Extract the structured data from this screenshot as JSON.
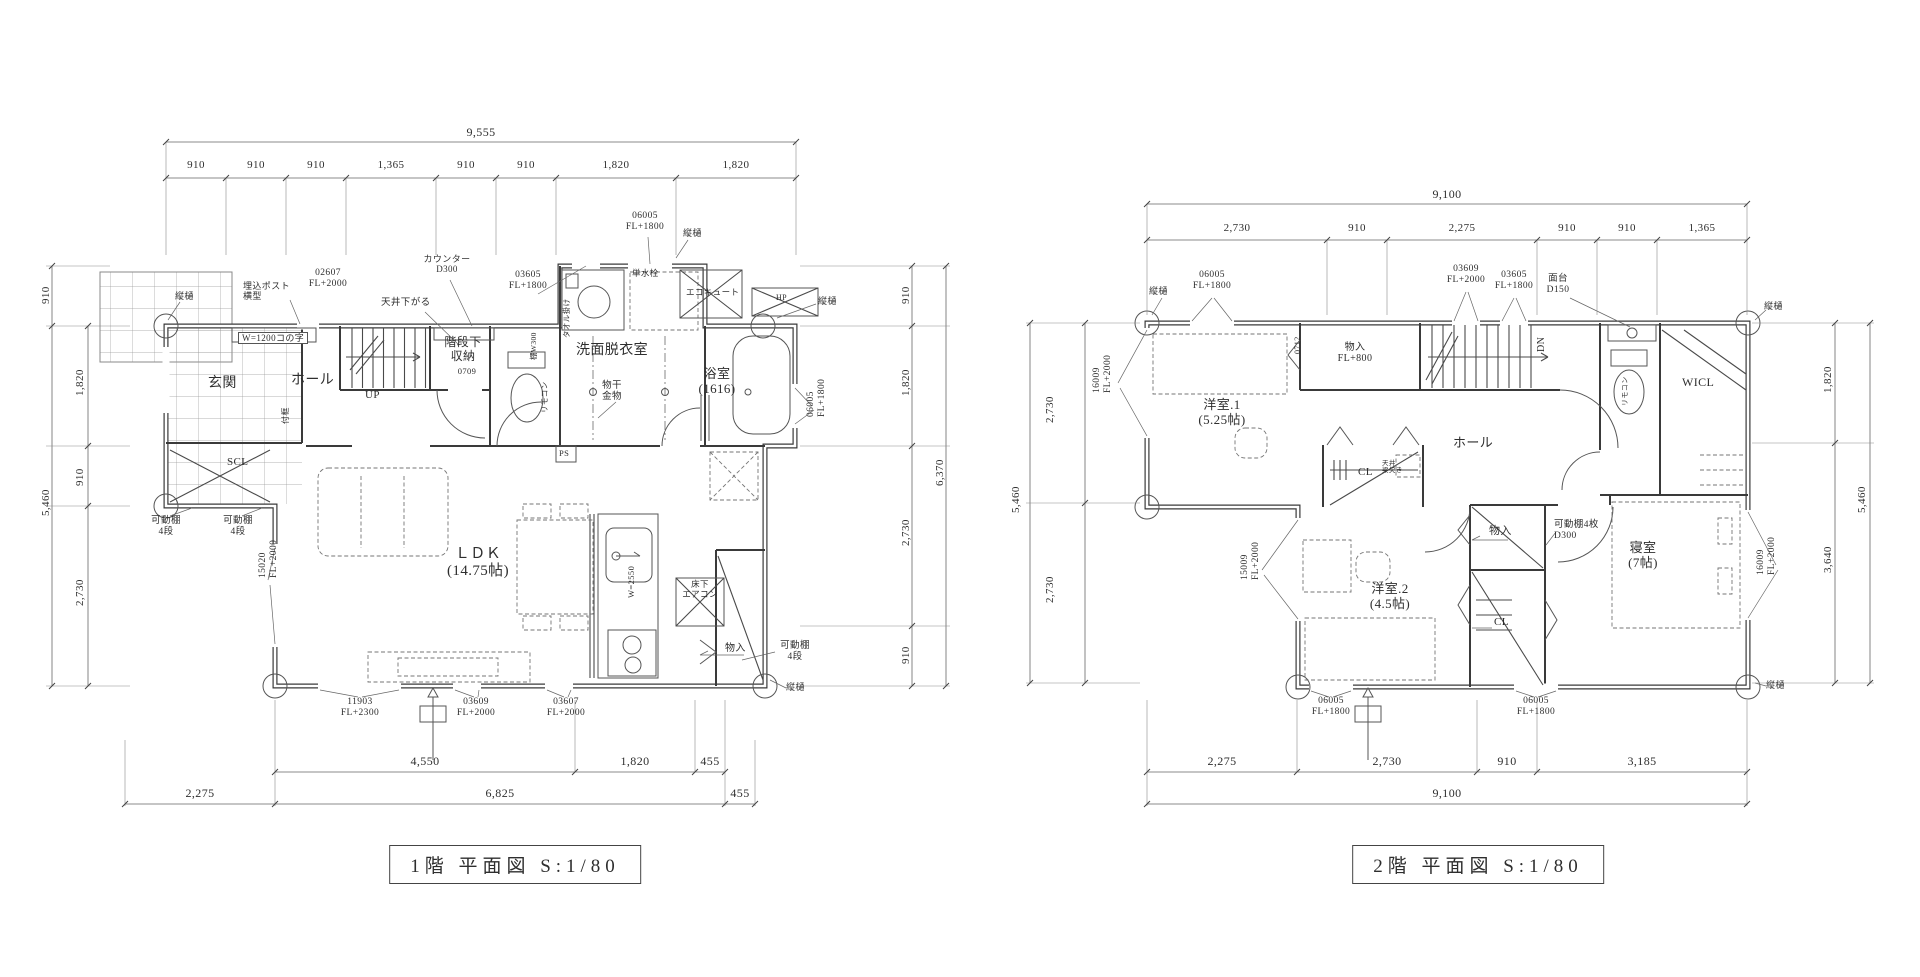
{
  "sheet": {
    "background": "#ffffff",
    "line_color": "#3a3a3a"
  },
  "floor1": {
    "title": "1階  平面図 S:1/80",
    "labels": [
      {
        "n": "dim-overall-width",
        "t": "9,555",
        "x": 481,
        "y": 126,
        "fs": 12,
        "c": 1
      },
      {
        "n": "dim-seg",
        "t": "910",
        "x": 196,
        "y": 159,
        "fs": 11,
        "c": 1
      },
      {
        "n": "dim-seg",
        "t": "910",
        "x": 256,
        "y": 159,
        "fs": 11,
        "c": 1
      },
      {
        "n": "dim-seg",
        "t": "910",
        "x": 316,
        "y": 159,
        "fs": 11,
        "c": 1
      },
      {
        "n": "dim-seg",
        "t": "1,365",
        "x": 391,
        "y": 159,
        "fs": 11,
        "c": 1
      },
      {
        "n": "dim-seg",
        "t": "910",
        "x": 466,
        "y": 159,
        "fs": 11,
        "c": 1
      },
      {
        "n": "dim-seg",
        "t": "910",
        "x": 526,
        "y": 159,
        "fs": 11,
        "c": 1
      },
      {
        "n": "dim-seg",
        "t": "1,820",
        "x": 616,
        "y": 159,
        "fs": 11,
        "c": 1
      },
      {
        "n": "dim-seg",
        "t": "1,820",
        "x": 736,
        "y": 159,
        "fs": 11,
        "c": 1
      },
      {
        "n": "downspout-label",
        "t": "縦樋",
        "x": 175,
        "y": 291,
        "fs": 9
      },
      {
        "n": "post-label",
        "t": "埋込ポスト\n横型",
        "x": 243,
        "y": 281,
        "fs": 9
      },
      {
        "n": "window-code",
        "t": "02607\nFL+2000",
        "x": 328,
        "y": 268,
        "fs": 9.5,
        "c": 1
      },
      {
        "n": "shelf-label",
        "t": "W=1200コの字",
        "x": 238,
        "y": 332,
        "fs": 9,
        "b": 1
      },
      {
        "n": "ceiling-label",
        "t": "天井下がる",
        "x": 381,
        "y": 298,
        "fs": 9.5
      },
      {
        "n": "counter-label",
        "t": "カウンター\nD300",
        "x": 447,
        "y": 254,
        "fs": 9,
        "c": 1
      },
      {
        "n": "room-label",
        "t": "階段下\n収納",
        "x": 463,
        "y": 336,
        "fs": 12,
        "c": 1
      },
      {
        "n": "door-code",
        "t": "0709",
        "x": 467,
        "y": 367,
        "fs": 8.5,
        "c": 1
      },
      {
        "n": "window-code",
        "t": "03605\nFL+1800",
        "x": 528,
        "y": 270,
        "fs": 9.5,
        "c": 1
      },
      {
        "n": "window-code",
        "t": "06005\nFL+1800",
        "x": 645,
        "y": 211,
        "fs": 9.5,
        "c": 1
      },
      {
        "n": "downspout-label",
        "t": "縦樋",
        "x": 683,
        "y": 228,
        "fs": 9
      },
      {
        "n": "fixture-label",
        "t": "単水栓",
        "x": 632,
        "y": 269,
        "fs": 8.5
      },
      {
        "n": "equipment-label",
        "t": "エコキュート",
        "x": 686,
        "y": 288,
        "fs": 8.5
      },
      {
        "n": "equipment-label",
        "t": "HP",
        "x": 776,
        "y": 293,
        "fs": 8
      },
      {
        "n": "downspout-label",
        "t": "縦樋",
        "x": 818,
        "y": 296,
        "fs": 9
      },
      {
        "n": "room-label",
        "t": "玄関",
        "x": 208,
        "y": 376,
        "fs": 14
      },
      {
        "n": "room-label",
        "t": "ホール",
        "x": 291,
        "y": 373,
        "fs": 14
      },
      {
        "n": "stair-label",
        "t": "UP",
        "x": 365,
        "y": 389,
        "fs": 11
      },
      {
        "n": "room-label",
        "t": "洗面脱衣室",
        "x": 576,
        "y": 343,
        "fs": 14
      },
      {
        "n": "fixture-label",
        "t": "物干\n金物",
        "x": 612,
        "y": 381,
        "fs": 9.5,
        "c": 1
      },
      {
        "n": "room-label",
        "t": "浴室\n(1616)",
        "x": 717,
        "y": 367,
        "fs": 13,
        "c": 1
      },
      {
        "n": "window-code",
        "t": "06005\nFL+1800",
        "x": 806,
        "y": 431,
        "fs": 9.5,
        "r": 1
      },
      {
        "n": "room-label",
        "t": "SCL",
        "x": 227,
        "y": 456,
        "fs": 11
      },
      {
        "n": "label",
        "t": "付框",
        "x": 281,
        "y": 438,
        "fs": 8,
        "r": 1
      },
      {
        "n": "label",
        "t": "棚W300",
        "x": 530,
        "y": 374,
        "fs": 7.5,
        "r": 1
      },
      {
        "n": "label",
        "t": "タオル掛け",
        "x": 563,
        "y": 352,
        "fs": 7.5,
        "r": 1
      },
      {
        "n": "label",
        "t": "リモコン",
        "x": 541,
        "y": 427,
        "fs": 7.5,
        "r": 1
      },
      {
        "n": "label",
        "t": "PS",
        "x": 559,
        "y": 449,
        "fs": 8.5
      },
      {
        "n": "shelf-label",
        "t": "可動棚\n4段",
        "x": 166,
        "y": 516,
        "fs": 9.5,
        "c": 1
      },
      {
        "n": "shelf-label",
        "t": "可動棚\n4段",
        "x": 238,
        "y": 516,
        "fs": 9.5,
        "c": 1
      },
      {
        "n": "window-code",
        "t": "15020\nFL+2000",
        "x": 258,
        "y": 592,
        "fs": 9.5,
        "r": 1
      },
      {
        "n": "room-label",
        "t": "ＬＤＫ\n(14.75帖)",
        "x": 478,
        "y": 546,
        "fs": 15,
        "c": 1
      },
      {
        "n": "label",
        "t": "W=2550",
        "x": 627,
        "y": 612,
        "fs": 8.5,
        "r": 1
      },
      {
        "n": "equipment-label",
        "t": "床下\nエアコン",
        "x": 700,
        "y": 580,
        "fs": 8.5,
        "c": 1
      },
      {
        "n": "room-label",
        "t": "物入",
        "x": 725,
        "y": 643,
        "fs": 10
      },
      {
        "n": "shelf-label",
        "t": "可動棚\n4段",
        "x": 795,
        "y": 641,
        "fs": 9.5,
        "c": 1
      },
      {
        "n": "downspout-label",
        "t": "縦樋",
        "x": 786,
        "y": 682,
        "fs": 9
      },
      {
        "n": "window-code",
        "t": "11903\nFL+2300",
        "x": 360,
        "y": 697,
        "fs": 9.5,
        "c": 1
      },
      {
        "n": "window-code",
        "t": "03609\nFL+2000",
        "x": 476,
        "y": 697,
        "fs": 9.5,
        "c": 1
      },
      {
        "n": "window-code",
        "t": "03607\nFL+2000",
        "x": 566,
        "y": 697,
        "fs": 9.5,
        "c": 1
      },
      {
        "n": "dim-seg",
        "t": "4,550",
        "x": 425,
        "y": 755,
        "fs": 12,
        "c": 1
      },
      {
        "n": "dim-seg",
        "t": "1,820",
        "x": 635,
        "y": 755,
        "fs": 12,
        "c": 1
      },
      {
        "n": "dim-seg",
        "t": "455",
        "x": 710,
        "y": 755,
        "fs": 12,
        "c": 1
      },
      {
        "n": "dim-seg",
        "t": "2,275",
        "x": 200,
        "y": 787,
        "fs": 12,
        "c": 1
      },
      {
        "n": "dim-seg",
        "t": "6,825",
        "x": 500,
        "y": 787,
        "fs": 12,
        "c": 1
      },
      {
        "n": "dim-seg",
        "t": "455",
        "x": 740,
        "y": 787,
        "fs": 12,
        "c": 1
      },
      {
        "n": "dim-seg",
        "t": "910",
        "x": 40,
        "y": 318,
        "fs": 11,
        "r": 1
      },
      {
        "n": "dim-overall-height",
        "t": "5,460",
        "x": 40,
        "y": 530,
        "fs": 11,
        "r": 1
      },
      {
        "n": "dim-seg",
        "t": "1,820",
        "x": 74,
        "y": 410,
        "fs": 11,
        "r": 1
      },
      {
        "n": "dim-seg",
        "t": "910",
        "x": 74,
        "y": 500,
        "fs": 11,
        "r": 1
      },
      {
        "n": "dim-seg",
        "t": "2,730",
        "x": 74,
        "y": 620,
        "fs": 11,
        "r": 1
      },
      {
        "n": "dim-seg",
        "t": "910",
        "x": 900,
        "y": 318,
        "fs": 11,
        "r": 1
      },
      {
        "n": "dim-seg",
        "t": "1,820",
        "x": 900,
        "y": 410,
        "fs": 11,
        "r": 1
      },
      {
        "n": "dim-seg",
        "t": "2,730",
        "x": 900,
        "y": 560,
        "fs": 11,
        "r": 1
      },
      {
        "n": "dim-seg",
        "t": "910",
        "x": 900,
        "y": 678,
        "fs": 11,
        "r": 1
      },
      {
        "n": "dim-overall-height",
        "t": "6,370",
        "x": 934,
        "y": 500,
        "fs": 11,
        "r": 1
      }
    ]
  },
  "floor2": {
    "title": "2階  平面図 S:1/80",
    "labels": [
      {
        "n": "dim-overall-width",
        "t": "9,100",
        "x": 1447,
        "y": 188,
        "fs": 12,
        "c": 1
      },
      {
        "n": "dim-seg",
        "t": "2,730",
        "x": 1237,
        "y": 222,
        "fs": 11,
        "c": 1
      },
      {
        "n": "dim-seg",
        "t": "910",
        "x": 1357,
        "y": 222,
        "fs": 11,
        "c": 1
      },
      {
        "n": "dim-seg",
        "t": "2,275",
        "x": 1462,
        "y": 222,
        "fs": 11,
        "c": 1
      },
      {
        "n": "dim-seg",
        "t": "910",
        "x": 1567,
        "y": 222,
        "fs": 11,
        "c": 1
      },
      {
        "n": "dim-seg",
        "t": "910",
        "x": 1627,
        "y": 222,
        "fs": 11,
        "c": 1
      },
      {
        "n": "dim-seg",
        "t": "1,365",
        "x": 1702,
        "y": 222,
        "fs": 11,
        "c": 1
      },
      {
        "n": "downspout-label",
        "t": "縦樋",
        "x": 1149,
        "y": 286,
        "fs": 9
      },
      {
        "n": "window-code",
        "t": "06005\nFL+1800",
        "x": 1212,
        "y": 270,
        "fs": 9.5,
        "c": 1
      },
      {
        "n": "window-code",
        "t": "03609\nFL+2000",
        "x": 1466,
        "y": 264,
        "fs": 9.5,
        "c": 1
      },
      {
        "n": "window-code",
        "t": "03605\nFL+1800",
        "x": 1514,
        "y": 270,
        "fs": 9.5,
        "c": 1
      },
      {
        "n": "fixture-label",
        "t": "面台\nD150",
        "x": 1558,
        "y": 274,
        "fs": 9.5,
        "c": 1
      },
      {
        "n": "downspout-label",
        "t": "縦樋",
        "x": 1764,
        "y": 301,
        "fs": 9
      },
      {
        "n": "window-code",
        "t": "16009\nFL+2000",
        "x": 1092,
        "y": 407,
        "fs": 9.5,
        "r": 1
      },
      {
        "n": "door-code",
        "t": "0712",
        "x": 1293,
        "y": 368,
        "fs": 8,
        "r": 1
      },
      {
        "n": "room-label",
        "t": "物入\nFL+800",
        "x": 1355,
        "y": 342,
        "fs": 10,
        "c": 1
      },
      {
        "n": "stair-label",
        "t": "DN",
        "x": 1536,
        "y": 366,
        "fs": 10,
        "r": 1
      },
      {
        "n": "room-label",
        "t": "洋室.1\n(5.25帖)",
        "x": 1222,
        "y": 398,
        "fs": 13,
        "c": 1
      },
      {
        "n": "room-label",
        "t": "ホール",
        "x": 1453,
        "y": 436,
        "fs": 13
      },
      {
        "n": "room-label",
        "t": "CL",
        "x": 1358,
        "y": 466,
        "fs": 11
      },
      {
        "n": "label",
        "t": "天井\n梁欠き",
        "x": 1382,
        "y": 460,
        "fs": 6.5
      },
      {
        "n": "room-label",
        "t": "WICL",
        "x": 1682,
        "y": 376,
        "fs": 12
      },
      {
        "n": "label",
        "t": "リモコン",
        "x": 1622,
        "y": 420,
        "fs": 7,
        "r": 1
      },
      {
        "n": "shelf-label",
        "t": "可動棚4枚\nD300",
        "x": 1554,
        "y": 520,
        "fs": 9.5
      },
      {
        "n": "room-label",
        "t": "物入",
        "x": 1489,
        "y": 525,
        "fs": 11
      },
      {
        "n": "room-label",
        "t": "寝室\n(7帖)",
        "x": 1643,
        "y": 541,
        "fs": 13,
        "c": 1
      },
      {
        "n": "window-code",
        "t": "16009\nFL+2000",
        "x": 1756,
        "y": 589,
        "fs": 9.5,
        "r": 1
      },
      {
        "n": "window-code",
        "t": "15009\nFL+2000",
        "x": 1240,
        "y": 594,
        "fs": 9.5,
        "r": 1
      },
      {
        "n": "room-label",
        "t": "洋室.2\n(4.5帖)",
        "x": 1390,
        "y": 582,
        "fs": 13,
        "c": 1
      },
      {
        "n": "room-label",
        "t": "CL",
        "x": 1494,
        "y": 616,
        "fs": 11
      },
      {
        "n": "window-code",
        "t": "06005\nFL+1800",
        "x": 1331,
        "y": 696,
        "fs": 9.5,
        "c": 1
      },
      {
        "n": "window-code",
        "t": "06005\nFL+1800",
        "x": 1536,
        "y": 696,
        "fs": 9.5,
        "c": 1
      },
      {
        "n": "downspout-label",
        "t": "縦樋",
        "x": 1766,
        "y": 680,
        "fs": 9
      },
      {
        "n": "dim-seg",
        "t": "2,275",
        "x": 1222,
        "y": 755,
        "fs": 12,
        "c": 1
      },
      {
        "n": "dim-seg",
        "t": "2,730",
        "x": 1387,
        "y": 755,
        "fs": 12,
        "c": 1
      },
      {
        "n": "dim-seg",
        "t": "910",
        "x": 1507,
        "y": 755,
        "fs": 12,
        "c": 1
      },
      {
        "n": "dim-seg",
        "t": "3,185",
        "x": 1642,
        "y": 755,
        "fs": 12,
        "c": 1
      },
      {
        "n": "dim-overall-width",
        "t": "9,100",
        "x": 1447,
        "y": 787,
        "fs": 12,
        "c": 1
      },
      {
        "n": "dim-seg",
        "t": "2,730",
        "x": 1044,
        "y": 437,
        "fs": 11,
        "r": 1
      },
      {
        "n": "dim-seg",
        "t": "2,730",
        "x": 1044,
        "y": 617,
        "fs": 11,
        "r": 1
      },
      {
        "n": "dim-overall-height",
        "t": "5,460",
        "x": 1010,
        "y": 527,
        "fs": 11,
        "r": 1
      },
      {
        "n": "dim-seg",
        "t": "1,820",
        "x": 1822,
        "y": 407,
        "fs": 11,
        "r": 1
      },
      {
        "n": "dim-seg",
        "t": "3,640",
        "x": 1822,
        "y": 587,
        "fs": 11,
        "r": 1
      },
      {
        "n": "dim-overall-height",
        "t": "5,460",
        "x": 1856,
        "y": 527,
        "fs": 11,
        "r": 1
      }
    ]
  }
}
